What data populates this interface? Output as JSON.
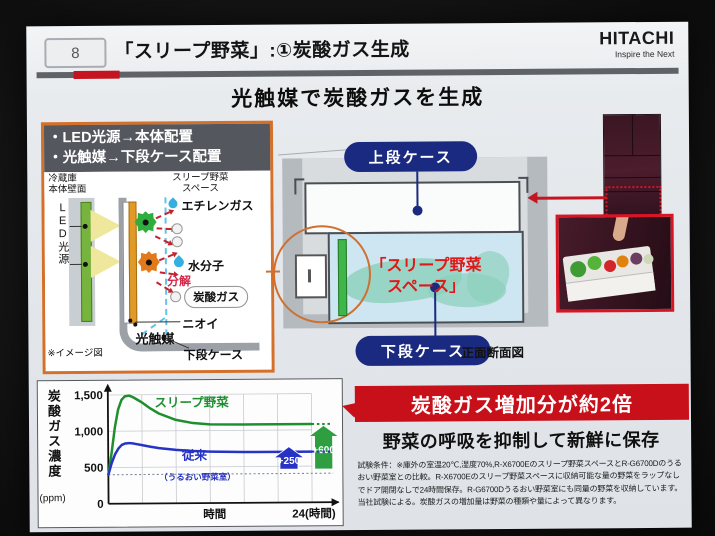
{
  "header": {
    "slide_number": "8",
    "title": "「スリープ野菜」:①炭酸ガス生成",
    "brand": "HITACHI",
    "tagline": "Inspire the Next"
  },
  "heading": "光触媒で炭酸ガスを生成",
  "left_panel": {
    "bullets": [
      "・LED光源→本体配置",
      "・光触媒→下段ケース配置"
    ],
    "labels": {
      "wall": "冷蔵庫\n本体壁面",
      "space": "スリープ野菜\nスペース",
      "led": "LED光源",
      "ethylene": "エチレンガス",
      "water": "水分子",
      "decompose": "分解",
      "co2": "炭酸ガス",
      "odor": "ニオイ",
      "photocatalyst": "光触媒",
      "lower_case": "下段ケース",
      "note": "※イメージ図"
    }
  },
  "cross_section": {
    "upper_case": "上段ケース",
    "space_label": "「スリープ野菜\nスペース」",
    "lower_case": "下段ケース",
    "caption": "正面断面図"
  },
  "result": {
    "banner": "炭酸ガス増加分が約2倍",
    "subtitle": "野菜の呼吸を抑制して新鮮に保存",
    "fine_print": "試験条件：※庫外の室温20℃,湿度70%,R-X6700Eのスリープ野菜スペースとR-G6700Dのうる\nおい野菜室との比較。R-X6700Eのスリープ野菜スペースに収納可能な量の野菜をラップなし\nでドア開閉なしで24時間保存。R-G6700Dうるおい野菜室にも同量の野菜を収納しています。\n当社試験による。炭酸ガスの増加量は野菜の種類や量によって異なります。"
  },
  "chart_data": {
    "type": "line",
    "ylabel": "炭酸ガス濃度",
    "y_unit": "(ppm)",
    "xlabel": "時間",
    "x_end_label": "24(時間)",
    "x_end": 24,
    "xlim": [
      0,
      27
    ],
    "ylim": [
      0,
      1600
    ],
    "yticks": [
      0,
      500,
      1000,
      1500
    ],
    "ytick_labels": [
      "0",
      "500",
      "1,000",
      "1,500"
    ],
    "x_grid": [
      4,
      8,
      12,
      16,
      20,
      24
    ],
    "y_grid": [
      500,
      1000,
      1500
    ],
    "baseline": 400,
    "series": [
      {
        "name": "スリープ野菜",
        "color": "#1e8f2f",
        "x": [
          0,
          0.4,
          0.8,
          1.2,
          1.6,
          2,
          2.5,
          3,
          4,
          5,
          6,
          8,
          10,
          12,
          16,
          20,
          24
        ],
        "y": [
          400,
          700,
          1050,
          1300,
          1430,
          1480,
          1490,
          1465,
          1395,
          1310,
          1240,
          1150,
          1105,
          1085,
          1080,
          1080,
          1080
        ],
        "end_value": 1080,
        "label_x": 5.5,
        "label_y": 1330,
        "arrow": {
          "label": "+600",
          "x": 25.4,
          "y0": 460,
          "y1": 1060,
          "color": "#2f9e41"
        }
      },
      {
        "name": "従来",
        "subname": "（うるおい野菜室）",
        "color": "#2733c4",
        "x": [
          0,
          0.4,
          0.8,
          1.2,
          1.6,
          2,
          2.5,
          3,
          4,
          5,
          6,
          8,
          10,
          12,
          16,
          20,
          24
        ],
        "y": [
          400,
          560,
          680,
          760,
          810,
          830,
          835,
          828,
          805,
          782,
          762,
          736,
          720,
          710,
          700,
          700,
          700
        ],
        "end_value": 700,
        "label_x": 8.7,
        "label_y": 600,
        "sub_x": 6.0,
        "sub_y": 320,
        "arrow": {
          "label": "+250",
          "x": 21.3,
          "y0": 460,
          "y1": 770,
          "color": "#2733c4"
        }
      }
    ]
  },
  "colors": {
    "banner_red": "#c8101a",
    "accent_red": "#c41420",
    "navy_pill": "#1a2a80",
    "orange_highlight": "#cf7030",
    "series_green": "#1e8f2f",
    "series_blue": "#2733c4",
    "led_green": "#76b43e",
    "photocatalyst_orange": "#e09a28"
  }
}
